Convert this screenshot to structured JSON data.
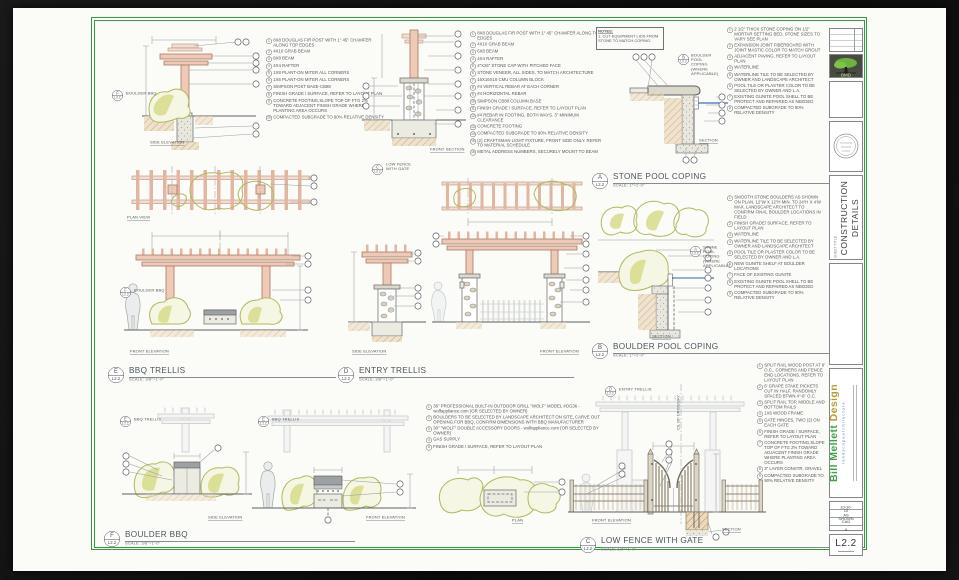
{
  "sheet": {
    "border_color": "#2f9e3f",
    "title_block": {
      "logo_text": "BMD",
      "sheet_title_label": "SHEET TITLE",
      "sheet_title_line1": "CONSTRUCTION",
      "sheet_title_line2": "DETAILS",
      "brand_name": "Bill Mellett",
      "brand_name2": "Design",
      "brand_tagline": "l a n d s c a p e   a r c h i t e c t u r e",
      "info_values": [
        "10-10-10",
        "AS SHOWN",
        "CAD",
        "A"
      ],
      "sheet_number": "L2.2"
    }
  },
  "details": [
    {
      "letter": "E",
      "sheet_ref": "L2.2",
      "title": "BBQ TRELLIS",
      "scale": "SCALE: 3/8\"=1'-0\"",
      "labels": {
        "side": "SIDE ELEVATION",
        "plan": "PLAN VIEW",
        "front": "FRONT ELEVATION"
      },
      "ref": {
        "letter": "F",
        "sheet": "L2.2",
        "label": "BOULDER BBQ"
      },
      "notes": [
        "8X8 DOUGLAS FIR POST WITH 1\" 45° CHAMFER ALONG TOP EDGES",
        "4X10 GRAB BEAM",
        "6X8 BEAM",
        "4X4 RAFTER",
        "1X8 PLANT-ON MITER ALL CORNERS",
        "1X6 PLANT-ON MITER ALL CORNERS",
        "SIMPSON POST BASE-CB88",
        "FINISH GRADE / SURFACE, REFER TO LAYOUT PLAN",
        "CONCRETE FOOTING,SLOPE TOP OF FTG 2% TOWARD ADJACENT FINISH GRADE WHERE PLANTING AREA OCCURS",
        "COMPACTED SUBGRADE TO 90% RELATIVE DENSITY"
      ]
    },
    {
      "letter": "D",
      "sheet_ref": "L2.2",
      "title": "ENTRY TRELLIS",
      "scale": "SCALE: 3/8\"=1'-0\"",
      "labels": {
        "front_section": "FRONT SECTION",
        "side": "SIDE ELEVATION",
        "front": "FRONT ELEVATION"
      },
      "ref": {
        "letter": "C",
        "sheet": "L2.2",
        "label": "LOW FENCE WITH GATE"
      },
      "notes": [
        "8X8 DOUGLAS FIR POST WITH 1\" 45° CHAMFER ALONG TOP EDGES",
        "4X10 GRAB BEAM",
        "6X8 BEAM",
        "4X4 RAFTER",
        "4\"X26\" STONE CAP WITH PITCHED FACE",
        "STONE VENEER, ALL SIDES, TO MATCH ARCHITECTURE",
        "16X16X16 CMU COLUMN BLOCK",
        "#4 VERTICAL REBAR AT EACH CORNER",
        "#4 HORIZONTAL REBAR",
        "SIMPSON CB88 COLUMN BASE",
        "FINISH GRADE / SURFACE, REFER TO LAYOUT PLAN",
        "#4 REBAR IN FOOTING, BOTH WAYS. 3\" MINIMUM CLEARANCE",
        "CONCRETE FOOTING",
        "COMPACTED SUBGRADE TO 90% RELATIVE DENSITY",
        "(2) CRAFTSMAN LIGHT FIXTURE, FRONT SIDE ONLY. REFER TO MATERIAL SCHEDULE",
        "METAL ADDRESS NUMBERS, SECURELY MOUNT TO BEAM"
      ]
    },
    {
      "letter": "A",
      "sheet_ref": "L2.2",
      "title": "STONE POOL COPING",
      "scale": "SCALE: 1\"=1'-0\"",
      "labels": {
        "section": "SECTION"
      },
      "ref": {
        "letter": "B",
        "sheet": "L2.2",
        "label": "BOULDER POOL COPING (WHERE APPLICABLE)"
      },
      "notes_box_title": "NOTES:",
      "notes_box_body": "1. CUT EQUIPMENT LIDS FROM STONE TO MATCH COPING.",
      "notes": [
        "2 1/2\" THICK STONE COPING ON 1/2\" MORTAR SETTING BED. STONE SIZES TO VARY SEE PLAN",
        "EXPANSION JOINT FIBERBOARD WITH JOINT MASTIC COLOR TO MATCH GROUT",
        "ADJACENT PAVING, REFER TO LAYOUT PLAN",
        "WATERLINE",
        "WATERLINE TILE TO BE SELECTED BY OWNER AND LANDSCAPE ARCHITECT",
        "POOL TILE OR PLASTER COLOR TO BE SELECTED BY OWNER AND L.A.",
        "EXISTING GUNITE POOL SHELL TO BE PROTECT AND REPAIRED AS NEEDED",
        "COMPACTED SUBGRADE TO 90% RELATIVE DENSITY"
      ]
    },
    {
      "letter": "B",
      "sheet_ref": "L2.2",
      "title": "BOULDER POOL COPING",
      "scale": "SCALE: 1\"=1'-0\"",
      "labels": {
        "section": "SECTION"
      },
      "ref": {
        "letter": "A",
        "sheet": "L2.2",
        "label": "STONE POOL COPING (WHERE APPLICABLE)"
      },
      "notes": [
        "SMOOTH STONE BOULDERS AS SHOWN ON PLAN. 12\"W X 12\"H MIN. TO 24\"H X 4'W MAX. LANDSCAPE ARCHITECT TO CONFIRM FINAL BOULDER LOCATIONS IN FIELD",
        "FINISH GRADE/ SURFACE, REFER TO LAYOUT PLAN",
        "WATERLINE",
        "WATERLINE TILE TO BE SELECTED BY OWNER AND LANDSCAPE ARCHITECT",
        "POOL TILE OR PLASTER COLOR TO BE SELECTED BY OWNER AND L.A.",
        "NEW GUNITE SHELF AT BOULDER LOCATIONS",
        "FACE OF EXISTING GUNITE",
        "EXISTING GUNITE POOL SHELL TO BE PROTECT AND REPAIRED AS NEEDED",
        "COMPACTED SUBGRADE TO 90% RELATIVE DENSITY"
      ]
    },
    {
      "letter": "F",
      "sheet_ref": "L2.2",
      "title": "BOULDER BBQ",
      "scale": "SCALE: 3/8\"=1'-0\"",
      "labels": {
        "side": "SIDE ELEVATION",
        "front": "FRONT ELEVATION",
        "plan": "PLAN"
      },
      "ref": {
        "letter": "E",
        "sheet": "L2.2",
        "label": "BBQ TRELLIS"
      },
      "notes": [
        "36\" PROFESSIONAL BUILT-IN OUTDOOR GRILL \"WOLF\" MODEL #OG36 - wolfappliance.com (OR SELECTED BY OWNER)",
        "BOULDERS TO BE SELECTED BY LANDSCAPE ARCHITECT ON SITE, CARVE OUT OPENING FOR BBQ, CONFIRM DIMENSIONS WITH BBQ MANUFACTURER",
        "30\" \"WOLF\" DOUBLE ACCESSORY DOORS - wolfappliance.com (OR SELECTED BY OWNER)",
        "GAS SUPPLY",
        "FINISH GRADE / SURFACE, REFER TO LAYOUT PLAN"
      ]
    },
    {
      "letter": "C",
      "sheet_ref": "L2.2",
      "title": "LOW FENCE WITH GATE",
      "scale": "SCALE: 1/2\"=1'-0\"",
      "labels": {
        "front": "FRONT ELEVATION",
        "section": "SECTION",
        "centerline": "C/L OF DRIVEWAY"
      },
      "ref": {
        "letter": "D",
        "sheet": "L2.2",
        "label": "ENTRY TRELLIS"
      },
      "notes": [
        "SPLIT RAIL WOOD POST AT 8' O.C., CORNERS AND FENCE END LOCATIONS, REFER TO LAYOUT PLAN",
        "6' GRAPE STAKE PICKETS CUT IN HALF, RANDOMLY SPACED BTWN 4\"-6\" O.C.",
        "SPLIT RAIL TOP, MIDDLE AND BOTTOM RAILS",
        "1X6 WOOD FRAME",
        "GATE HINGES, TWO (2) ON EACH GATE",
        "FINISH GRADE / SURFACE, REFER TO LAYOUT PLAN",
        "CONCRETE FOOTING,SLOPE TOP OF FTG 2% TOWARD ADJACENT FINISH GRADE WHERE PLANTING AREA OCCURS",
        "3\" LAYER CONSTR. GRAVEL",
        "COMPACTED SUBGRADE TO 90% RELATIVE DENSITY"
      ]
    }
  ]
}
